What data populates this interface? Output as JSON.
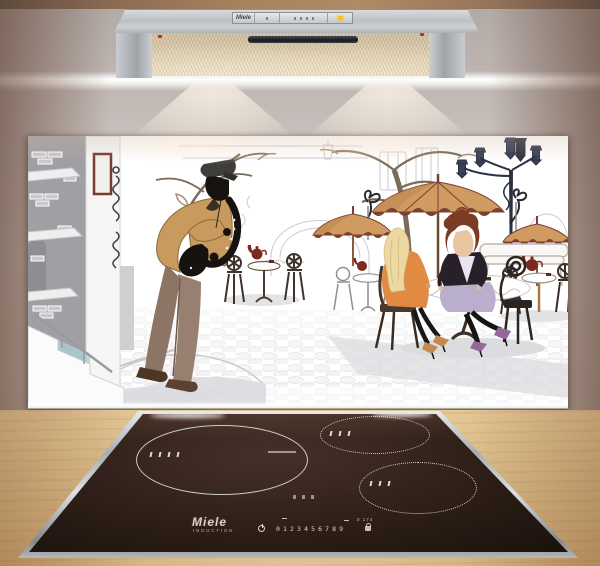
{
  "scene": {
    "description": "Kitchen product photo: glass splashback with street-cafe jazz saxophonist artwork between a stainless cooker hood and a black induction hob on a wooden worktop"
  },
  "hood": {
    "brand": "Miele",
    "indicator_icon": "amber-led",
    "controls": [
      "power-button",
      "fan-level-buttons",
      "light-button"
    ]
  },
  "cooktop": {
    "brand": "Miele",
    "subbrand": "INDUCTION",
    "digits": [
      "0",
      "1",
      "2",
      "3",
      "4",
      "5",
      "6",
      "7",
      "8",
      "9"
    ],
    "aux_markings": "0 174",
    "icons": [
      "power-icon",
      "lock-icon"
    ],
    "zones": [
      "large-left-zone",
      "top-right-zone",
      "bottom-right-zone"
    ]
  },
  "artwork": {
    "subject": "street cafes with saxophonist, umbrellas, lamppost and two women at a table"
  },
  "colors": {
    "hood_led": "#f5c11e",
    "umbrella": "#cf9b60",
    "jacket": "#c99a5e",
    "glass_bg": "#ffffff",
    "hob_glass": "#2d1e17",
    "worktop": "#dcbc8a"
  }
}
